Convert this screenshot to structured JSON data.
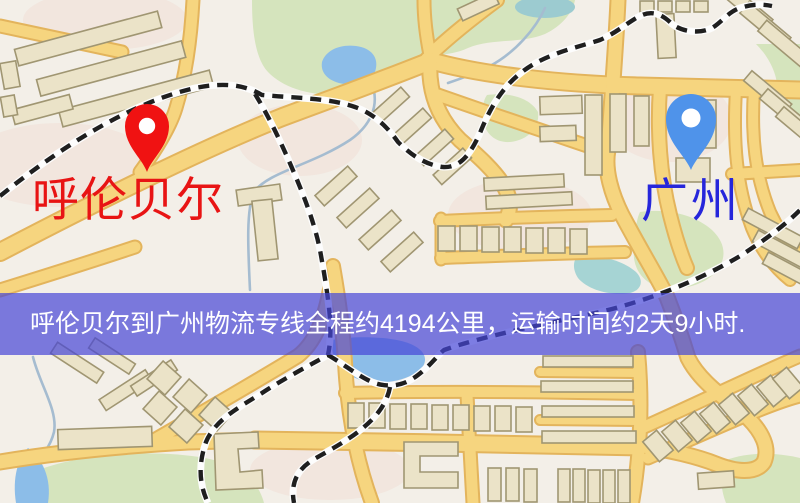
{
  "map": {
    "origin": {
      "label": "呼伦贝尔",
      "pin_color": "#f01212",
      "label_color": "#e81414"
    },
    "destination": {
      "label": "广州",
      "pin_color": "#4f93ea",
      "label_color": "#2626db"
    },
    "banner": {
      "text": "呼伦贝尔到广州物流专线全程约4194公里，运输时间约2天9小时.",
      "distance_km": "4194",
      "duration": "2天9小时",
      "bg_color": "rgba(70,70,215,0.70)",
      "text_color": "#ffffff"
    },
    "icons": {
      "origin_pin": "map-marker-icon",
      "destination_pin": "map-marker-icon"
    },
    "colors": {
      "background": "#f3efe8",
      "road_core": "#f6d57f",
      "road_casing": "#e3b45c",
      "railway": "#1f1f1f",
      "park_green": "#d5e4bd",
      "water_blue": "#8cbde8",
      "pond_teal": "#9ccbd0",
      "building_fill": "#ebe3c8",
      "building_stroke": "#a09672"
    }
  }
}
